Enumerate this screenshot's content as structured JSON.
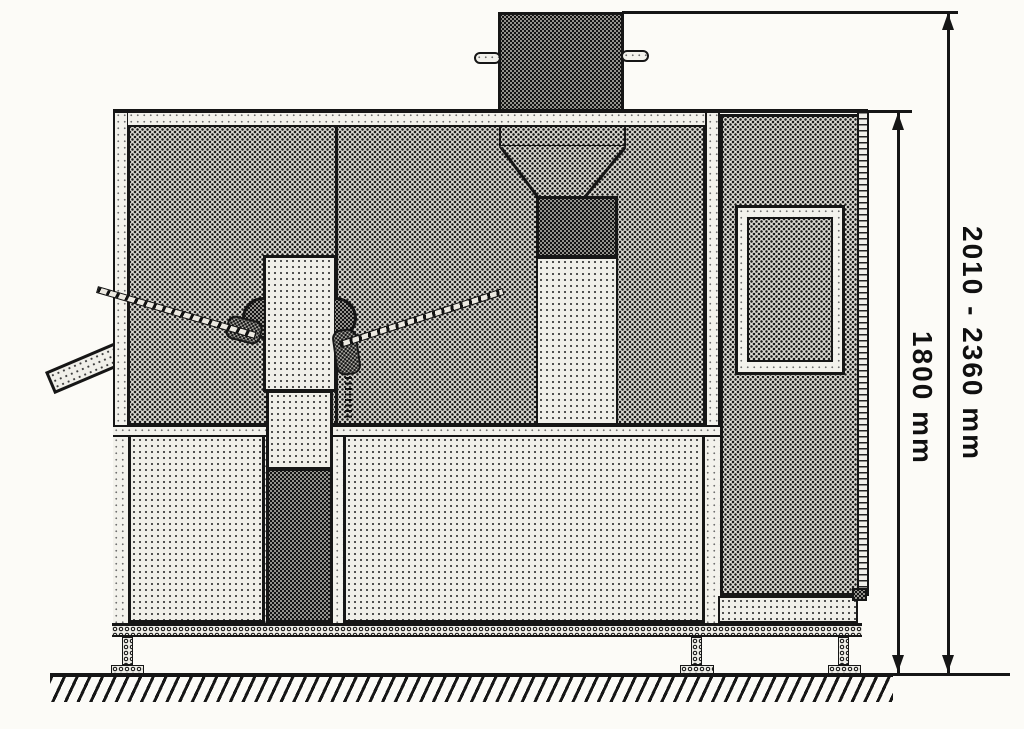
{
  "diagram": {
    "type": "technical-drawing",
    "subject": "machine-side-elevation",
    "dimensions": {
      "overall_height_label": "2010 - 2360 mm",
      "body_height_label": "1800 mm"
    },
    "colors": {
      "line": "#161616",
      "paper": "#fcfbf7",
      "fill_dark": "#dedcd5",
      "fill_light": "#f0efe9"
    }
  }
}
